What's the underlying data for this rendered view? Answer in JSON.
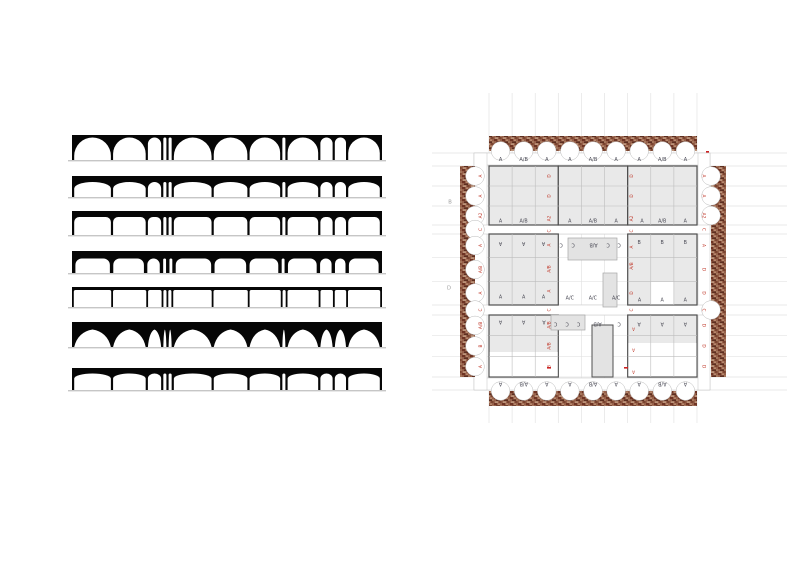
{
  "title": "arch-typology-and-plan-study",
  "left_panel": {
    "x": 68,
    "width": 310,
    "svg_w": 318,
    "fill": "#060606",
    "baseline_color": "#c6c6c6",
    "bay_widths": [
      36,
      32,
      13,
      3,
      3,
      37,
      33,
      30,
      3,
      30,
      12,
      11,
      31
    ],
    "strips": [
      {
        "name": "semicircular-arches",
        "y": 135,
        "h": 25,
        "t": 2.5,
        "profile": "round"
      },
      {
        "name": "elliptical-arches",
        "y": 176,
        "h": 21,
        "t": 6,
        "profile": "ellipse",
        "cap": 6.5
      },
      {
        "name": "segmental-arches",
        "y": 211,
        "h": 24,
        "t": 6,
        "profile": "seg",
        "cap": 5
      },
      {
        "name": "flat-arches",
        "y": 251,
        "h": 22,
        "t": 7.5,
        "profile": "seg",
        "cap": 6.5,
        "pier": 3.4
      },
      {
        "name": "trabeated-lintel",
        "y": 287,
        "h": 20,
        "t": 3,
        "profile": "seg",
        "cap": 1.8,
        "pier": 1.8
      },
      {
        "name": "tented-arches",
        "y": 322,
        "h": 25,
        "t": 7.5,
        "profile": "tent"
      },
      {
        "name": "shallow-arches",
        "y": 368,
        "h": 22,
        "t": 5.5,
        "profile": "ellipse",
        "cap": 5
      }
    ]
  },
  "plan": {
    "x": 430,
    "y": 85,
    "w": 360,
    "h": 350,
    "colors": {
      "red": "#c0392b",
      "slate": "#4a4a55",
      "room": "#e9e9e9",
      "outline": "#4f4f4f",
      "cell": "#bdbdbd",
      "grid": "#e3e3e3",
      "band": "#c2c2c2",
      "court": "#e3e3e3",
      "court_line": "#a5a5a5",
      "scallop_line": "#b9b9b9",
      "outside": "#9a9a9a",
      "mark": "#cc2222",
      "brick_base": "#96604a",
      "brick_dark1": "#6e3424",
      "brick_dark2": "#55281c",
      "brick_mid": "#a5765c",
      "brick_light1": "#b88a6e",
      "brick_light2": "#c09a80",
      "brick_shadow": "#7a4430"
    },
    "top_labels": [
      "A",
      "A/B",
      "A",
      "A",
      "A/B",
      "A",
      "A",
      "A/B",
      "A"
    ],
    "bottom_labels": [
      "A",
      "A/B",
      "A",
      "A",
      "A/B",
      "A",
      "A",
      "A/B",
      "A"
    ],
    "left_labels": [
      "A",
      "A",
      "A2",
      "C",
      "A",
      "A/B",
      "A",
      "C",
      "A/B",
      "B",
      "A"
    ],
    "right_labels": [
      "A",
      "A",
      "A2",
      "C",
      "A",
      "D",
      "D",
      "C",
      "D",
      "D",
      "D"
    ],
    "side_ys": [
      91,
      111,
      130.5,
      144.5,
      160.5,
      184.5,
      208,
      225,
      240.4,
      261,
      281.6
    ],
    "outside_labels": [
      {
        "t": "B",
        "x": 20,
        "y": 117
      },
      {
        "t": "D",
        "x": 19,
        "y": 203
      }
    ],
    "interior_labels": [
      {
        "t": "A",
        "x": 70.5,
        "y": 136,
        "c": "s",
        "r": 0
      },
      {
        "t": "A/B",
        "x": 93.6,
        "y": 136,
        "c": "s",
        "r": 0
      },
      {
        "t": "A",
        "x": 139.8,
        "y": 136,
        "c": "s",
        "r": 0
      },
      {
        "t": "A/B",
        "x": 162.9,
        "y": 136,
        "c": "s",
        "r": 0
      },
      {
        "t": "A",
        "x": 186.1,
        "y": 136,
        "c": "s",
        "r": 0
      },
      {
        "t": "A",
        "x": 212,
        "y": 136,
        "c": "s",
        "r": 0
      },
      {
        "t": "A/B",
        "x": 232.2,
        "y": 136,
        "c": "s",
        "r": 0
      },
      {
        "t": "A",
        "x": 255.3,
        "y": 136,
        "c": "s",
        "r": 0
      },
      {
        "t": "B",
        "x": 209.1,
        "y": 157.5,
        "c": "s",
        "r": 0
      },
      {
        "t": "B",
        "x": 232.2,
        "y": 157.5,
        "c": "s",
        "r": 0
      },
      {
        "t": "B",
        "x": 255.3,
        "y": 157.5,
        "c": "s",
        "r": 0
      },
      {
        "t": "A",
        "x": 70.5,
        "y": 158.5,
        "c": "s",
        "r": 180
      },
      {
        "t": "A",
        "x": 93.6,
        "y": 158.5,
        "c": "s",
        "r": 180
      },
      {
        "t": "A",
        "x": 113.5,
        "y": 158.5,
        "c": "s",
        "r": 180
      },
      {
        "t": "C",
        "x": 131,
        "y": 160,
        "c": "s",
        "r": 180
      },
      {
        "t": "C",
        "x": 143,
        "y": 160,
        "c": "s",
        "r": 180
      },
      {
        "t": "A/B",
        "x": 163.5,
        "y": 160,
        "c": "s",
        "r": 180
      },
      {
        "t": "C",
        "x": 178,
        "y": 160,
        "c": "s",
        "r": 180
      },
      {
        "t": "C",
        "x": 189,
        "y": 160,
        "c": "s",
        "r": 180
      },
      {
        "t": "A",
        "x": 70.5,
        "y": 212,
        "c": "s",
        "r": 0
      },
      {
        "t": "A",
        "x": 93.6,
        "y": 212,
        "c": "s",
        "r": 0
      },
      {
        "t": "A",
        "x": 113.5,
        "y": 212,
        "c": "s",
        "r": 0
      },
      {
        "t": "A/C",
        "x": 139.8,
        "y": 213,
        "c": "s",
        "r": 0
      },
      {
        "t": "A/C",
        "x": 162.9,
        "y": 213,
        "c": "s",
        "r": 0
      },
      {
        "t": "A/C",
        "x": 186.1,
        "y": 213,
        "c": "s",
        "r": 0
      },
      {
        "t": "A",
        "x": 209.5,
        "y": 215,
        "c": "s",
        "r": 0
      },
      {
        "t": "A",
        "x": 232.2,
        "y": 215,
        "c": "s",
        "r": 0
      },
      {
        "t": "A",
        "x": 255.3,
        "y": 215,
        "c": "s",
        "r": 0
      },
      {
        "t": "A",
        "x": 70.5,
        "y": 237,
        "c": "s",
        "r": 180
      },
      {
        "t": "A",
        "x": 93.6,
        "y": 237,
        "c": "s",
        "r": 180
      },
      {
        "t": "A",
        "x": 114,
        "y": 237,
        "c": "s",
        "r": 180
      },
      {
        "t": "A",
        "x": 209.1,
        "y": 239,
        "c": "s",
        "r": 180
      },
      {
        "t": "A",
        "x": 232.2,
        "y": 239,
        "c": "s",
        "r": 180
      },
      {
        "t": "A",
        "x": 255.3,
        "y": 239,
        "c": "s",
        "r": 180
      },
      {
        "t": "C",
        "x": 125.5,
        "y": 239,
        "c": "s",
        "r": 180
      },
      {
        "t": "C",
        "x": 137,
        "y": 239,
        "c": "s",
        "r": 180
      },
      {
        "t": "C",
        "x": 148.5,
        "y": 239,
        "c": "s",
        "r": 180
      },
      {
        "t": "A/B",
        "x": 167.5,
        "y": 239,
        "c": "s",
        "r": 180
      },
      {
        "t": "C",
        "x": 189,
        "y": 239,
        "c": "s",
        "r": 180
      },
      {
        "t": "D",
        "x": 119,
        "y": 91,
        "c": "r",
        "r": -90
      },
      {
        "t": "D",
        "x": 119,
        "y": 111,
        "c": "r",
        "r": -90
      },
      {
        "t": "A2",
        "x": 119,
        "y": 133.5,
        "c": "r",
        "r": -90
      },
      {
        "t": "C",
        "x": 119,
        "y": 146,
        "c": "r",
        "r": -90
      },
      {
        "t": "A",
        "x": 119,
        "y": 160,
        "c": "r",
        "r": -90
      },
      {
        "t": "A/B",
        "x": 119,
        "y": 184,
        "c": "r",
        "r": -90
      },
      {
        "t": "A",
        "x": 119,
        "y": 206,
        "c": "r",
        "r": -90
      },
      {
        "t": "C",
        "x": 119,
        "y": 225,
        "c": "r",
        "r": -90
      },
      {
        "t": "A/B",
        "x": 119,
        "y": 240,
        "c": "r",
        "r": -90
      },
      {
        "t": "A/B",
        "x": 119,
        "y": 261,
        "c": "r",
        "r": -90
      },
      {
        "t": "B",
        "x": 119,
        "y": 281.5,
        "c": "r",
        "r": -90
      },
      {
        "t": "D",
        "x": 201.5,
        "y": 91,
        "c": "r",
        "r": -90
      },
      {
        "t": "D",
        "x": 201.5,
        "y": 111,
        "c": "r",
        "r": -90
      },
      {
        "t": "A2",
        "x": 201.5,
        "y": 133.5,
        "c": "r",
        "r": -90
      },
      {
        "t": "C",
        "x": 201.5,
        "y": 146,
        "c": "r",
        "r": -90
      },
      {
        "t": "A",
        "x": 201.5,
        "y": 162,
        "c": "r",
        "r": -90
      },
      {
        "t": "A/B",
        "x": 201.5,
        "y": 181,
        "c": "r",
        "r": -90
      },
      {
        "t": "D",
        "x": 201.5,
        "y": 208,
        "c": "r",
        "r": -90
      },
      {
        "t": "C",
        "x": 201.5,
        "y": 225,
        "c": "r",
        "r": -90
      },
      {
        "t": "A",
        "x": 203.5,
        "y": 244,
        "c": "r",
        "r": 180
      },
      {
        "t": "A",
        "x": 203.5,
        "y": 265,
        "c": "r",
        "r": 180
      },
      {
        "t": "A",
        "x": 203.5,
        "y": 287,
        "c": "r",
        "r": 180
      }
    ],
    "red_marks": [
      {
        "x": 276,
        "y": 66,
        "w": 3,
        "h": 1.6
      },
      {
        "x": 117,
        "y": 282,
        "w": 4,
        "h": 1.6
      },
      {
        "x": 194,
        "y": 282,
        "w": 4,
        "h": 1.6
      }
    ]
  }
}
